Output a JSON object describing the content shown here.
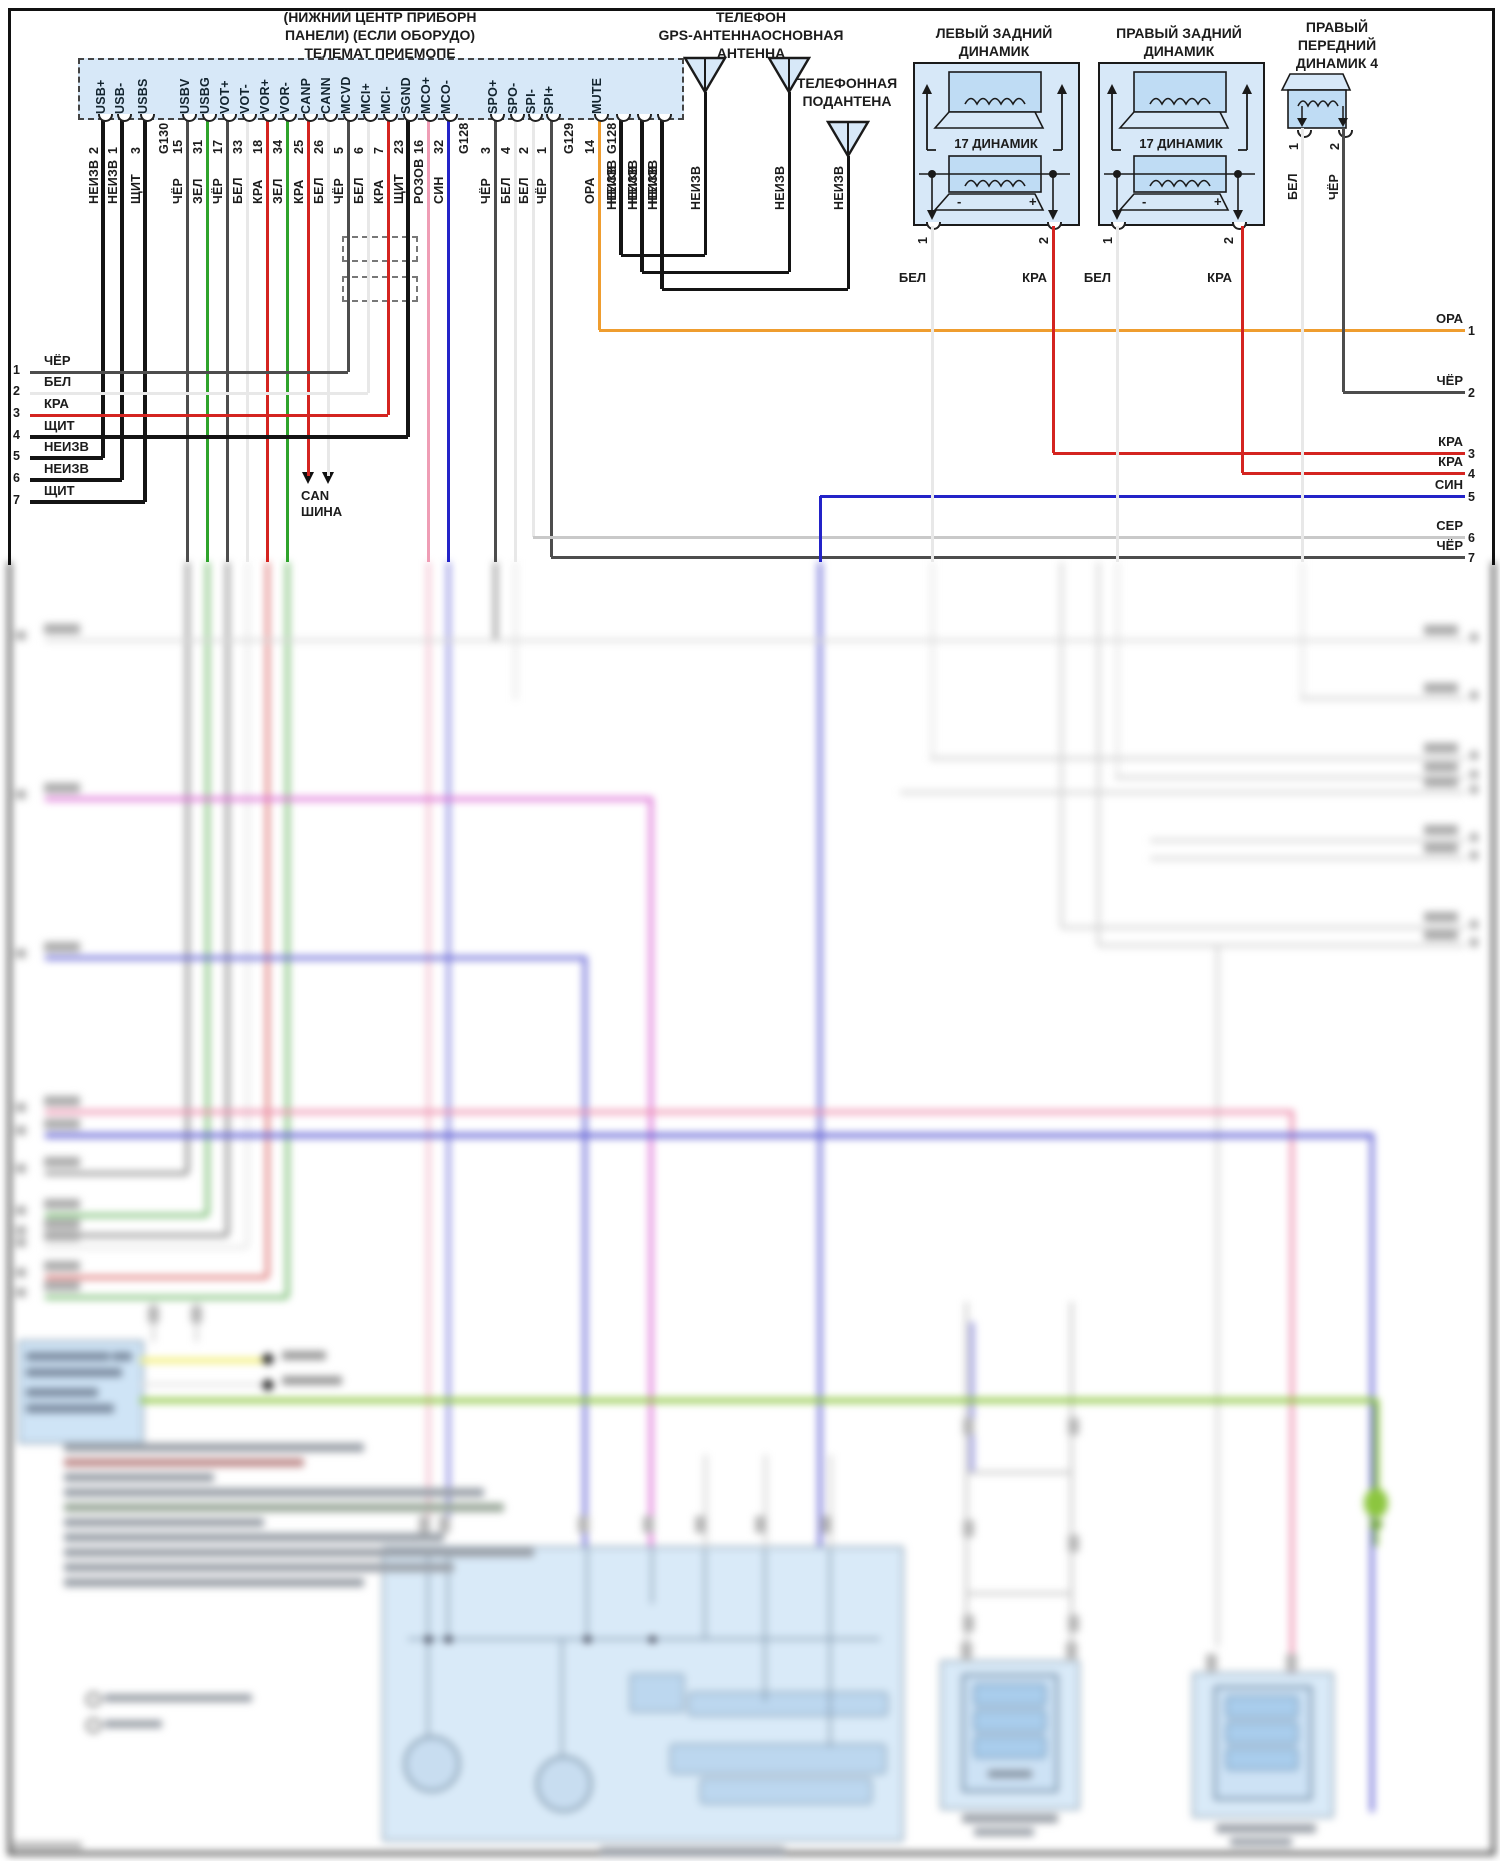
{
  "diagram": {
    "telemat": {
      "title_lines": [
        "(НИЖНИЙ ЦЕНТР ПРИБОРН",
        "ПАНЕЛИ) (ЕСЛИ ОБОРУДО)",
        "ТЕЛЕМАТ ПРИЕМОПЕ"
      ],
      "pins": [
        {
          "label": "USB+",
          "num": "2",
          "color": "НЕИЗВ"
        },
        {
          "label": "USB-",
          "num": "1",
          "color": "НЕИЗВ"
        },
        {
          "label": "USBS",
          "num": "3",
          "color": "ЩИТ"
        },
        {
          "label": "",
          "num": "G130",
          "color": ""
        },
        {
          "label": "USBV",
          "num": "15",
          "color": "ЧЁР"
        },
        {
          "label": "USBG",
          "num": "31",
          "color": "ЗЕЛ"
        },
        {
          "label": "VOT+",
          "num": "17",
          "color": "ЧЁР"
        },
        {
          "label": "VOT-",
          "num": "33",
          "color": "БЕЛ"
        },
        {
          "label": "VOR+",
          "num": "18",
          "color": "КРА"
        },
        {
          "label": "VOR-",
          "num": "34",
          "color": "ЗЕЛ"
        },
        {
          "label": "CANP",
          "num": "25",
          "color": "КРА"
        },
        {
          "label": "CANN",
          "num": "26",
          "color": "БЕЛ"
        },
        {
          "label": "MCVD",
          "num": "5",
          "color": "ЧЁР"
        },
        {
          "label": "MCI+",
          "num": "6",
          "color": "БЕЛ"
        },
        {
          "label": "MCI-",
          "num": "7",
          "color": "КРА"
        },
        {
          "label": "SGND",
          "num": "23",
          "color": "ЩИТ"
        },
        {
          "label": "MCO+",
          "num": "16",
          "color": "РОЗОВ"
        },
        {
          "label": "MCO-",
          "num": "32",
          "color": "СИН"
        },
        {
          "label": "",
          "num": "G128",
          "color": ""
        },
        {
          "label": "SPO+",
          "num": "3",
          "color": "ЧЁР"
        },
        {
          "label": "SPO-",
          "num": "4",
          "color": "БЕЛ"
        },
        {
          "label": "SPI-",
          "num": "2",
          "color": "БЕЛ"
        },
        {
          "label": "SPI+",
          "num": "1",
          "color": "ЧЁР"
        },
        {
          "label": "",
          "num": "G129",
          "color": ""
        },
        {
          "label": "MUTE",
          "num": "14",
          "color": "ОРА"
        },
        {
          "label": "",
          "num": "G128",
          "color": "НЕИЗВ"
        },
        {
          "label": "",
          "num": "",
          "color": "НЕИЗВ"
        },
        {
          "label": "",
          "num": "",
          "color": "НЕИЗВ"
        }
      ]
    },
    "antennas": {
      "group_title_lines": [
        "ТЕЛЕФОН",
        "GPS-АНТЕННАОСНОВНАЯ",
        "АНТЕННА"
      ],
      "sub_title_lines": [
        "ТЕЛЕФОННАЯ",
        "ПОДАНТЕНА"
      ],
      "wire_label": "НЕИЗВ"
    },
    "left_rows": [
      {
        "num": "1",
        "color": "ЧЁР"
      },
      {
        "num": "2",
        "color": "БЕЛ"
      },
      {
        "num": "3",
        "color": "КРА"
      },
      {
        "num": "4",
        "color": "ЩИТ"
      },
      {
        "num": "5",
        "color": "НЕИЗВ"
      },
      {
        "num": "6",
        "color": "НЕИЗВ"
      },
      {
        "num": "7",
        "color": "ЩИТ"
      }
    ],
    "right_rows": [
      {
        "num": "1",
        "color": "ОРА"
      },
      {
        "num": "2",
        "color": "ЧЁР"
      },
      {
        "num": "3",
        "color": "КРА"
      },
      {
        "num": "4",
        "color": "КРА"
      },
      {
        "num": "5",
        "color": "СИН"
      },
      {
        "num": "6",
        "color": "СЕР"
      },
      {
        "num": "7",
        "color": "ЧЁР"
      }
    ],
    "can_bus_lines": [
      "CAN",
      "ШИНА"
    ],
    "speakers": {
      "left_rear": {
        "title_lines": [
          "ЛЕВЫЙ ЗАДНИЙ",
          "ДИНАМИК"
        ],
        "unit_label": "17 ДИНАМИК",
        "minus": "-",
        "plus": "+",
        "terminals": [
          {
            "num": "1",
            "color": "БЕЛ"
          },
          {
            "num": "2",
            "color": "КРА"
          }
        ]
      },
      "right_rear": {
        "title_lines": [
          "ПРАВЫЙ ЗАДНИЙ",
          "ДИНАМИК"
        ],
        "unit_label": "17 ДИНАМИК",
        "minus": "-",
        "plus": "+",
        "terminals": [
          {
            "num": "1",
            "color": "БЕЛ"
          },
          {
            "num": "2",
            "color": "КРА"
          }
        ]
      },
      "front_right": {
        "title_lines": [
          "ПРАВЫЙ",
          "ПЕРЕДНИЙ",
          "ДИНАМИК 4"
        ],
        "terminals": [
          {
            "num": "1",
            "color": "БЕЛ"
          },
          {
            "num": "2",
            "color": "ЧЁР"
          }
        ]
      }
    },
    "colors": {
      "panel_fill": "#d7e8f8",
      "speaker_inner": "#bfdcf4",
      "wire_black": "#141414",
      "wire_dark_gray": "#4d4d4d",
      "wire_white": "#e8e8e8",
      "wire_green": "#2fa32b",
      "wire_red": "#d42420",
      "wire_pink": "#ef9db5",
      "wire_blue": "#2323c8",
      "wire_orange": "#ef9d2f",
      "wire_light_gray": "#c9c9c9"
    }
  }
}
